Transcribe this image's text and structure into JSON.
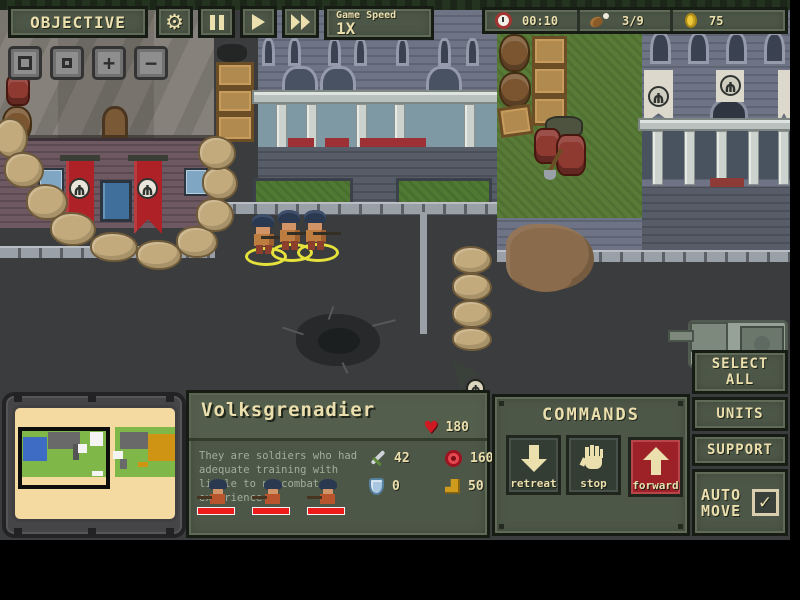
{
  "hud": {
    "objective_label": "OBJECTIVE",
    "game_speed_label": "Game Speed",
    "game_speed_value": "1X",
    "resources": {
      "time": "00:10",
      "food": "3/9",
      "gold": "75"
    }
  },
  "icons": {
    "gear": "⚙",
    "zoom_in": "+",
    "zoom_out": "−",
    "check": "✓",
    "heart": "♥",
    "emblem": "Ψ"
  },
  "unit_panel": {
    "name": "Volksgrenadier",
    "hp": "180",
    "description": "They are soldiers who had adequate training with little to no combat experience",
    "stats": {
      "sword": "42",
      "target": "160",
      "shield": "0",
      "boot": "50"
    }
  },
  "commands_panel": {
    "title": "COMMANDS",
    "retreat_label": "retreat",
    "stop_label": "stop",
    "forward_label": "forward"
  },
  "side_panel": {
    "select_all_label": "SELECT ALL",
    "units_label": "UNITS",
    "support_label": "SUPPORT",
    "auto_move_label": "AUTO MOVE",
    "auto_move_checked": true
  },
  "colors": {
    "panel_olive": "#4d5747",
    "cream_text": "#ecdfae",
    "banner_red": "#ae2126",
    "selection_yellow": "#e5e23c",
    "hp_red": "#ee1b1b",
    "road": "#3b3c3e",
    "grass": "#587b37",
    "minimap_paper": "#f4d9a0"
  }
}
